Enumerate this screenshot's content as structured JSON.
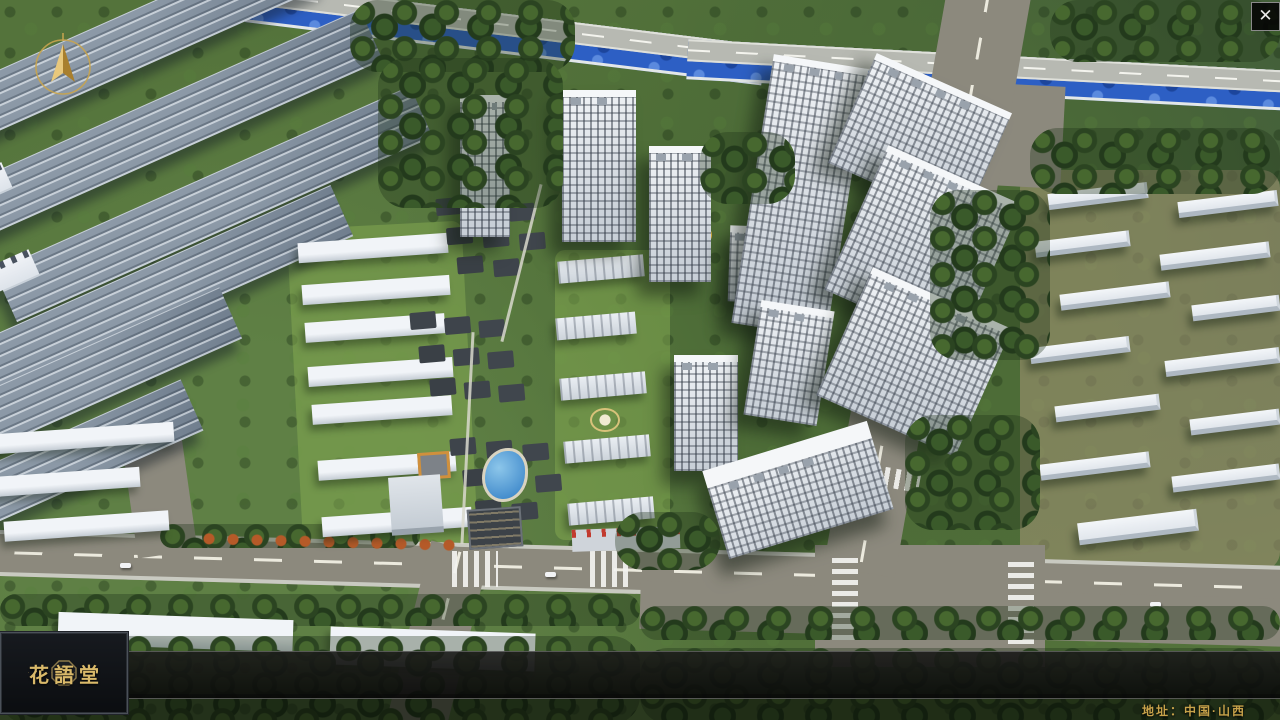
{
  "app": {
    "close_label": "✕"
  },
  "nav": {
    "logo": {
      "title": "花語堂",
      "subtitle": "· · · · · · · · · ·",
      "seal_icon": "octagonal-seal"
    },
    "items": [
      {
        "num": "o1",
        "zh": "品牌 · 介绍",
        "en": "BRAND SUPPORT"
      },
      {
        "num": "o2",
        "zh": "区位 · 价值",
        "en": "LOCATION VALUE"
      },
      {
        "num": "o3",
        "zh": "项目 · 概况",
        "en": "PROJECT SURVEY"
      },
      {
        "num": "o4",
        "zh": "建筑 · 鉴赏",
        "en": "APPRECIATION"
      },
      {
        "num": "o5",
        "zh": "园林 · 景观",
        "en": "GARDEN STREET"
      },
      {
        "num": "o6",
        "zh": "精装 · 体验",
        "en": "EXPERIENCE"
      },
      {
        "num": "o7",
        "zh": "户型 · 分布",
        "en": "SHOW ROOM"
      },
      {
        "num": "o8",
        "zh": "一房 · 一景",
        "en": "COMMUNITY"
      }
    ]
  },
  "footer": {
    "address": "地址：中国·山西"
  },
  "colors": {
    "accent_gold": "#C9A85C",
    "bar_background": "#121212",
    "river_blue": "#2D5FC4",
    "road_gray": "#8C897D",
    "tree_green": "#3A5A2A"
  }
}
